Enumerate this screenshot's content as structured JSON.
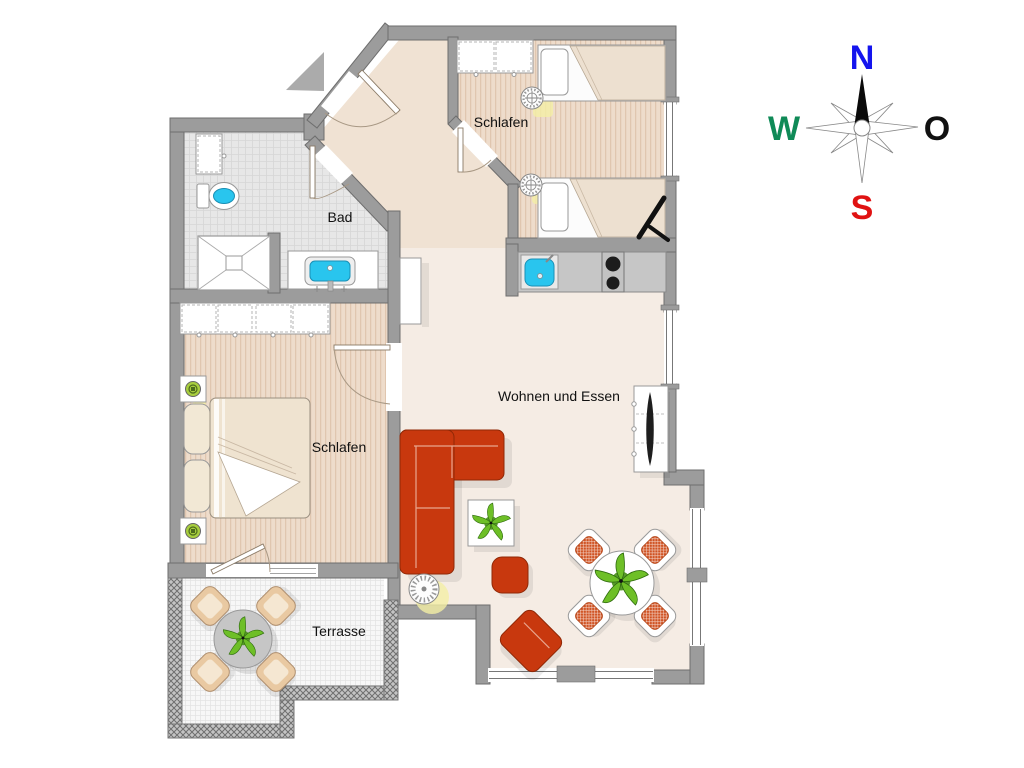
{
  "rooms": {
    "bedroom_top": {
      "label": "Schlafen"
    },
    "bedroom_left": {
      "label": "Schlafen"
    },
    "bathroom": {
      "label": "Bad"
    },
    "living": {
      "label": "Wohnen und Essen"
    },
    "terrace": {
      "label": "Terrasse"
    }
  },
  "compass": {
    "north": "N",
    "east": "O",
    "south": "S",
    "west": "W",
    "colors": {
      "north": "#1414EE",
      "east": "#111111",
      "south": "#E01212",
      "west": "#0F8A57"
    }
  },
  "colors": {
    "wall": "#9C9C9C",
    "wall_outline": "#6E6E6E",
    "floor_bedroom": "#EEDCCB",
    "floor_stripe": "#E0C6AF",
    "floor_living": "#F5ECE4",
    "floor_hall": "#F0E2D3",
    "floor_bath": "#E7E7E7",
    "bath_grid": "#D6D6D6",
    "floor_terrace": "#F7F7F7",
    "terrace_grid": "#E3E3E3",
    "sofa": "#C8380E",
    "sofa_outline": "#8F2806",
    "chair_seat": "#D05222",
    "terrace_chair": "#E9C9A2",
    "terrace_chair_seat": "#F5E7D2",
    "terrace_table": "#C6C6C6",
    "fixture": "#29C5EE",
    "fixture_outline": "#1A8FB5",
    "counter": "#C6C6C6",
    "blanket": "#EDE0D0",
    "plant": "#6EBF27",
    "plant_dark": "#4F9420",
    "glow": "#F4EFA5",
    "door_leaf_outline": "#8A7A66",
    "door_arc": "#A89884",
    "furniture_outline": "#999999",
    "label": "#111111",
    "arrow": "#ABABAB"
  }
}
